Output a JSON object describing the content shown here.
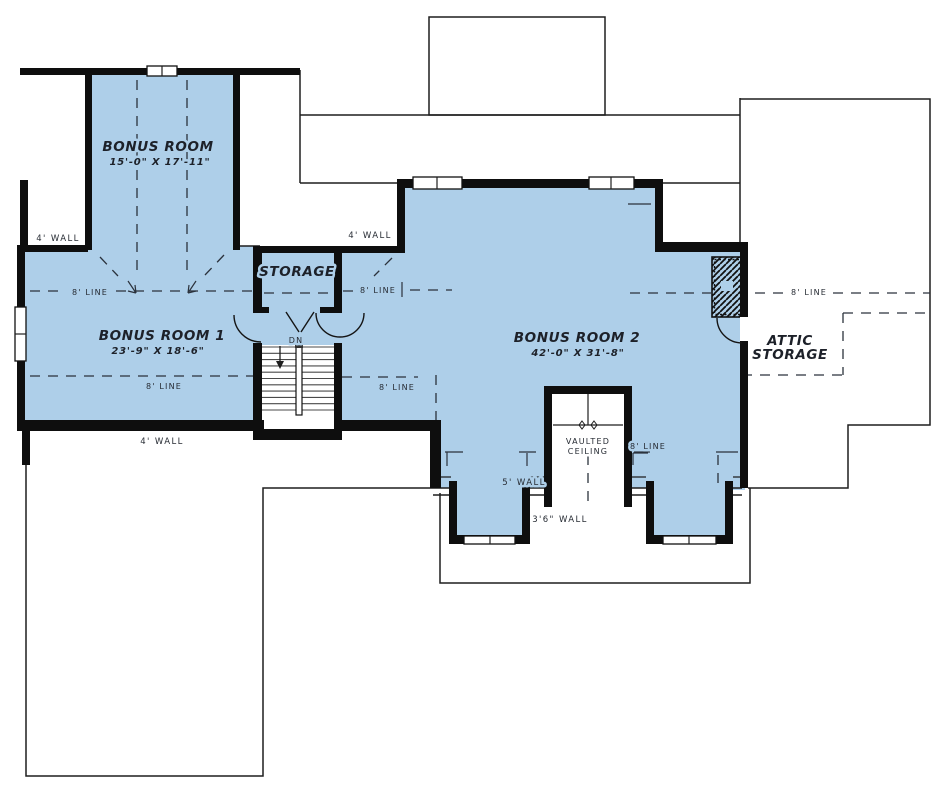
{
  "colors": {
    "room_fill": "#aecfe9",
    "wall": "#0e0e0e",
    "line": "#2b323c"
  },
  "rooms": {
    "bonus_room": {
      "name": "BONUS ROOM",
      "dims": "15'-0\" X 17'-11\""
    },
    "bonus_room_1": {
      "name": "BONUS ROOM 1",
      "dims": "23'-9\" X 18'-6\""
    },
    "bonus_room_2": {
      "name": "BONUS ROOM 2",
      "dims": "42'-0\" X 31'-8\""
    },
    "storage": {
      "name": "STORAGE"
    },
    "attic_storage": {
      "line1": "ATTIC",
      "line2": "STORAGE"
    },
    "vaulted_ceiling": {
      "line1": "VAULTED",
      "line2": "CEILING"
    }
  },
  "annotations": {
    "wall_4": "4' WALL",
    "wall_5": "5' WALL",
    "wall_3_6": "3'6\" WALL",
    "line_8": "8' LINE",
    "down": "DN"
  }
}
